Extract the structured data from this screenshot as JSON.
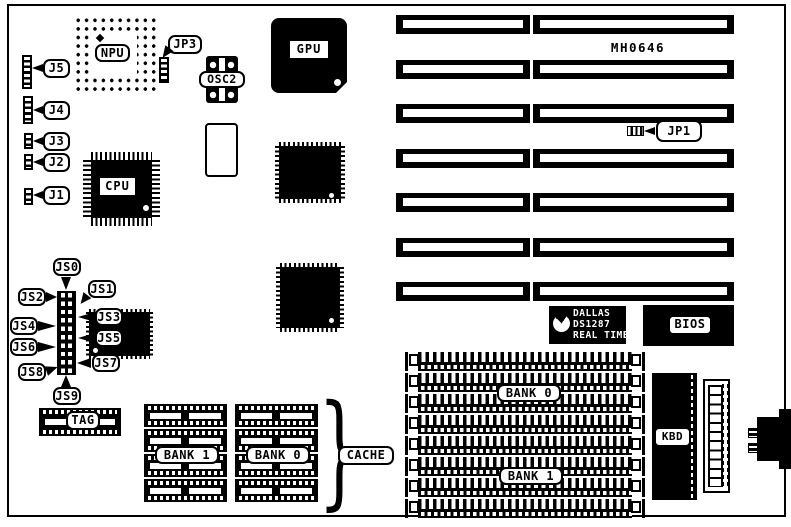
{
  "board": {
    "part_number": "MH0646"
  },
  "chips": {
    "npu": "NPU",
    "cpu": "CPU",
    "gpu": "GPU",
    "osc2": "OSC2",
    "kbd": "KBD",
    "bios": "BIOS",
    "dallas": {
      "line1": "DALLAS",
      "line2": "DS1287",
      "line3": "REAL TIME"
    }
  },
  "connectors": {
    "j1": "J1",
    "j2": "J2",
    "j3": "J3",
    "j4": "J4",
    "j5": "J5"
  },
  "jumpers": {
    "jp1": "JP1",
    "jp3": "JP3",
    "js0": "JS0",
    "js1": "JS1",
    "js2": "JS2",
    "js3": "JS3",
    "js4": "JS4",
    "js5": "JS5",
    "js6": "JS6",
    "js7": "JS7",
    "js8": "JS8",
    "js9": "JS9"
  },
  "memory": {
    "simm": {
      "bank0": "BANK 0",
      "bank1": "BANK 1"
    },
    "cache": {
      "bank0": "BANK 0",
      "bank1": "BANK 1",
      "label": "CACHE",
      "tag": "TAG",
      "brace_glyph": "}"
    }
  }
}
